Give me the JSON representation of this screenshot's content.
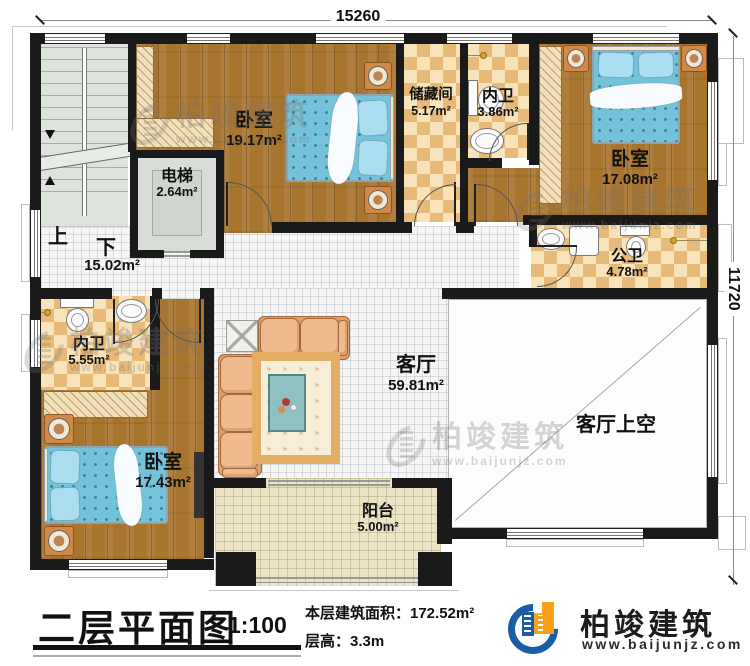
{
  "dimensions": {
    "top": "15260",
    "right": "11720"
  },
  "stairwell": {
    "up": "上",
    "down": "下",
    "hall_area": "15.02m²"
  },
  "rooms": {
    "bedroom_top": {
      "name": "卧室",
      "area": "19.17m²"
    },
    "elevator": {
      "name": "电梯",
      "area": "2.64m²"
    },
    "storage": {
      "name": "储藏间",
      "area": "5.17m²"
    },
    "ensuite_top": {
      "name": "内卫",
      "area": "3.86m²"
    },
    "bedroom_right": {
      "name": "卧室",
      "area": "17.08m²"
    },
    "public_bath": {
      "name": "公卫",
      "area": "4.78m²"
    },
    "living": {
      "name": "客厅",
      "area": "59.81m²"
    },
    "living_void": {
      "name": "客厅上空"
    },
    "ensuite_left": {
      "name": "内卫",
      "area": "5.55m²"
    },
    "bedroom_bottom": {
      "name": "卧室",
      "area": "17.43m²"
    },
    "balcony": {
      "name": "阳台",
      "area": "5.00m²"
    }
  },
  "titleblock": {
    "title": "二层平面图",
    "scale": "1:100",
    "floor_area": "本层建筑面积：172.52m²",
    "floor_height": "层高：3.3m"
  },
  "brand": {
    "name": "柏竣建筑",
    "website": "www.baijunjz.com"
  },
  "watermark": {
    "text": "柏竣建筑",
    "website": "www.baijunjz.com"
  },
  "colors": {
    "wall": "#1a1a1a",
    "wood": "#a8752f",
    "checker_dark": "#e7ba79",
    "checker_light": "#f8e3ba",
    "bed_blue": "#74c3da",
    "brand_blue": "#1a5ca5",
    "brand_orange": "#f7a11b"
  }
}
